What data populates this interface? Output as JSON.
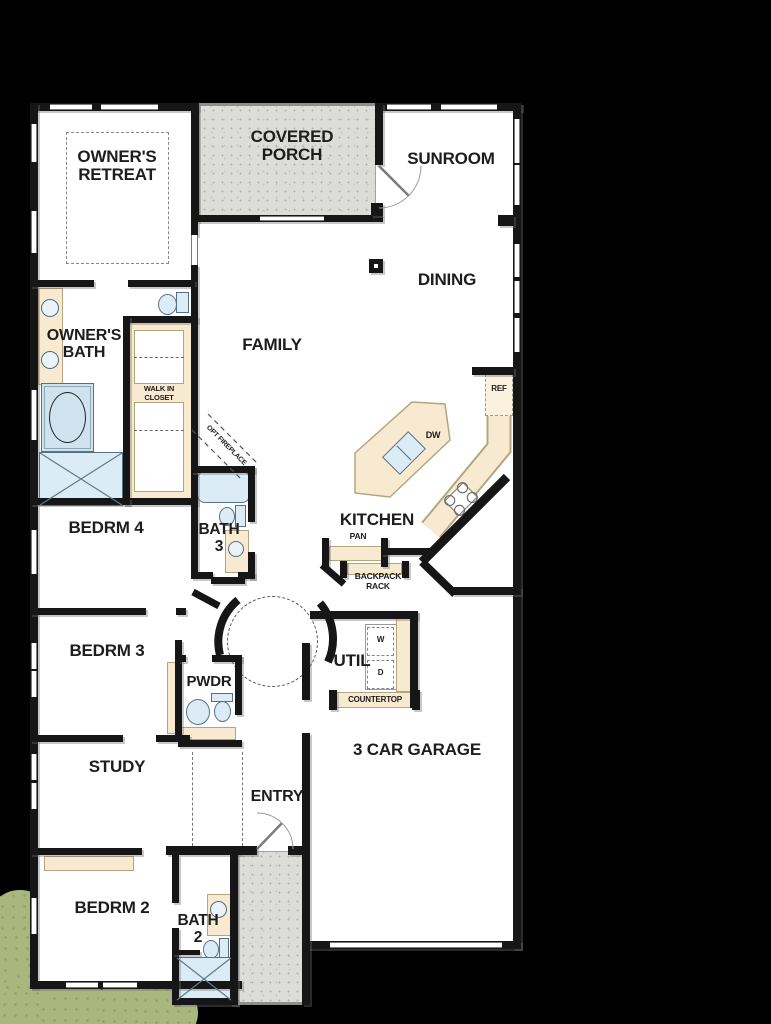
{
  "colors": {
    "background": "#000000",
    "walls": "#161616",
    "floor": "#ffffff",
    "porch_concrete": "#dcdcd8",
    "casework": "#f8ead0",
    "plumbing_fixture": "#dcecf6",
    "landscape": "#a9b77e"
  },
  "rooms": {
    "owners_retreat": "OWNER'S RETREAT",
    "covered_porch": "COVERED PORCH",
    "sunroom": "SUNROOM",
    "dining": "DINING",
    "family": "FAMILY",
    "owners_bath": "OWNER'S BATH",
    "walk_in_closet": "WALK IN CLOSET",
    "bedrm4": "BEDRM 4",
    "bath3": "BATH 3",
    "kitchen": "KITCHEN",
    "bedrm3": "BEDRM 3",
    "pwdr": "PWDR",
    "util": "UTIL",
    "study": "STUDY",
    "entry": "ENTRY",
    "garage": "3 CAR GARAGE",
    "bedrm2": "BEDRM 2",
    "bath2": "BATH 2"
  },
  "annotations": {
    "opt_fireplace": "OPT FIREPLACE",
    "pan": "PAN",
    "backpack_rack": "BACKPACK RACK",
    "ref": "REF",
    "dw": "DW",
    "washer": "W",
    "dryer": "D",
    "countertop": "COUNTERTOP"
  }
}
